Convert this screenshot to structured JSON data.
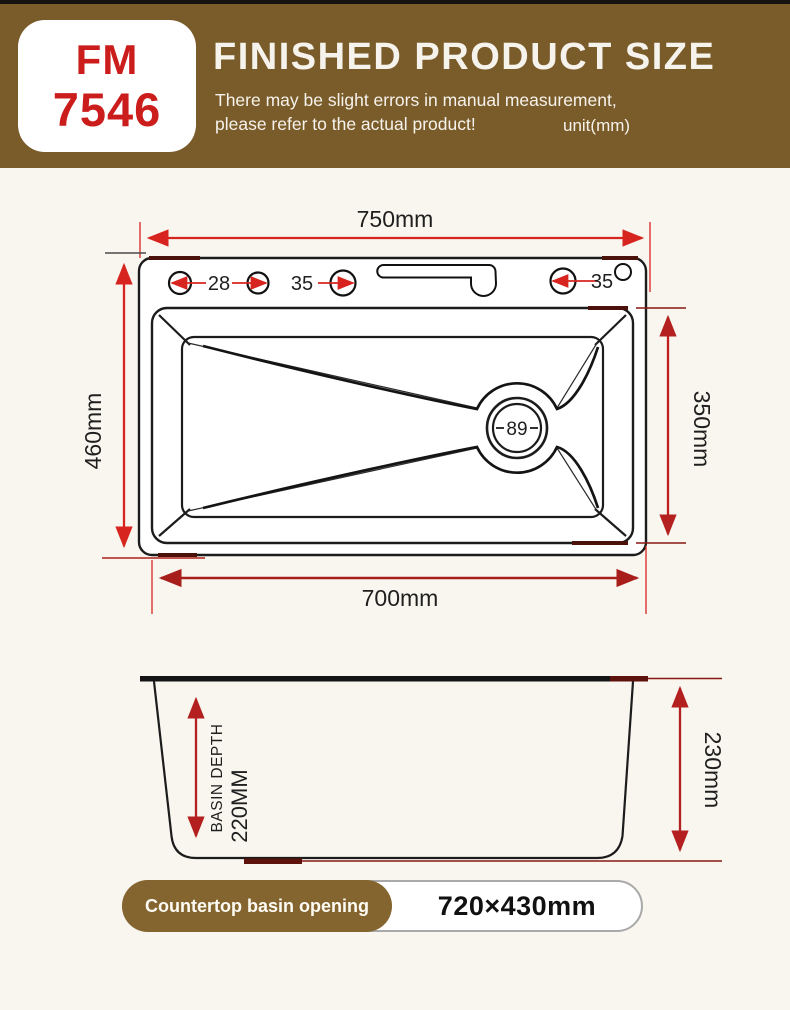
{
  "header": {
    "model_code_line1": "FM",
    "model_code_line2": "7546",
    "title": "FINISHED PRODUCT SIZE",
    "disclaimer_line1": "There may be slight errors in manual measurement,",
    "disclaimer_line2": "please refer to the actual product!",
    "unit_label": "unit(mm)"
  },
  "top_view": {
    "overall_width": "750mm",
    "overall_depth": "460mm",
    "inner_basin_depth": "350mm",
    "bottom_width": "700mm",
    "hole_left_diameter": "28",
    "hole_middle_diameter": "35",
    "hole_right_diameter": "35",
    "drain_diameter": "89"
  },
  "side_view": {
    "basin_depth_label": "BASIN DEPTH",
    "basin_depth_value": "220MM",
    "overall_height": "230mm"
  },
  "footer": {
    "badge_label": "Countertop basin opening",
    "badge_value": "720×430mm"
  },
  "colors": {
    "header_brown": "#7a5b2a",
    "badge_brown": "#85652f",
    "page_background": "#f8f6ee",
    "model_red": "#cc1d1d",
    "dimension_red": "#d8241f",
    "dimension_dark_red": "#a81e1a",
    "extension_maroon": "#8a1710",
    "line_black": "#1c1c1c"
  }
}
